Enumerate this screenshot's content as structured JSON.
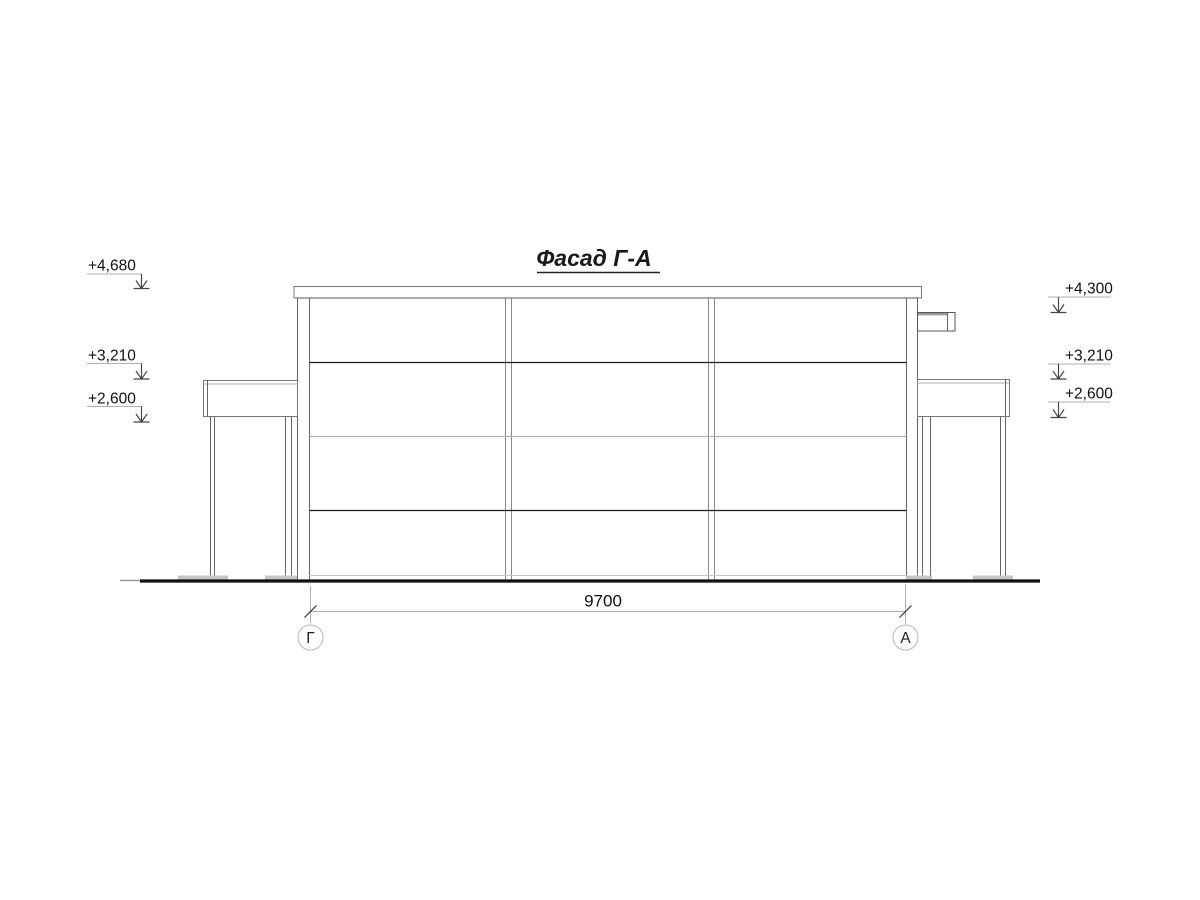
{
  "drawing": {
    "title": "Фасад Г-А",
    "dimension": {
      "value": "9700"
    },
    "axes": {
      "left": "Г",
      "right": "А"
    },
    "elevations_left": [
      {
        "value": "+4,680"
      },
      {
        "value": "+3,210"
      },
      {
        "value": "+2,600"
      }
    ],
    "elevations_right": [
      {
        "value": "+4,300"
      },
      {
        "value": "+3,210"
      },
      {
        "value": "+2,600"
      }
    ],
    "colors": {
      "background": "#ffffff",
      "line_dark": "#1c1c1c",
      "line_medium": "#666666",
      "line_light": "#b0b0b0",
      "text": "#111111"
    }
  }
}
